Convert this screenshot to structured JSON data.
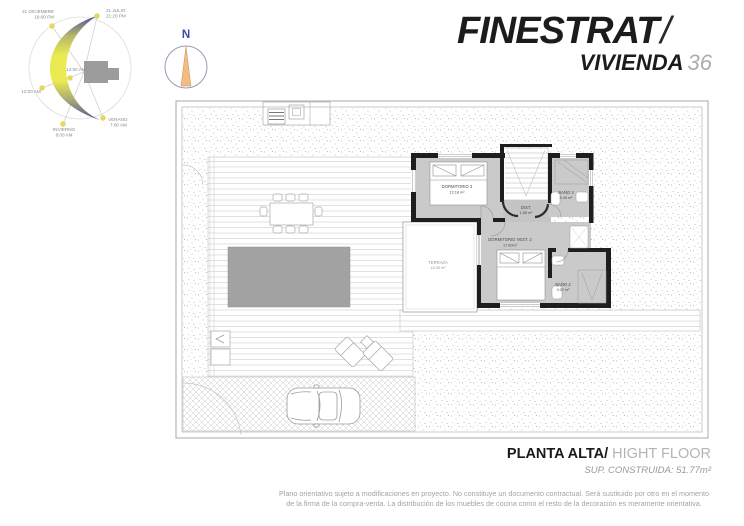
{
  "header": {
    "project_title": "FINESTRAT",
    "title_slash": "/",
    "unit_label": "VIVIENDA",
    "unit_number": "36"
  },
  "compass": {
    "north": "N"
  },
  "sun_diagram": {
    "winter_sunset_date": "21 DICIEMBRE",
    "winter_sunset_time": "18:00 PM",
    "summer_sunset_date": "21 JULIO",
    "summer_sunset_time": "21:20 PM",
    "noon_center": "12:00 AM",
    "noon_left": "12:00 AM",
    "winter_label": "INVIERNO",
    "winter_time": "8:00 AM",
    "summer_label": "VERANO",
    "summer_time": "7:00 AM"
  },
  "floorplan": {
    "rooms": [
      {
        "name": "DORMITORIO 3",
        "area": "12.18 m²"
      },
      {
        "name": "BAÑO 3",
        "area": "5.40 m²"
      },
      {
        "name": "DIST.",
        "area": "1.55 m²"
      },
      {
        "name": "DORMITORIO VEST. 2",
        "area": "17.60m²"
      },
      {
        "name": "TERRAZA",
        "area": "16.08 m²"
      },
      {
        "name": "BAÑO 2",
        "area": "4.07 m²"
      }
    ]
  },
  "footer": {
    "floor_name_es": "PLANTA ALTA/",
    "floor_name_en": "HIGHT FLOOR",
    "built_surface": "SUP. CONSTRUIDA: 51.77m²"
  },
  "disclaimer": {
    "line1": "Plano orientativo sujeto a modificaciones en proyecto. No constituye un documento contractual. Será sustituido por otro en el momento",
    "line2": "de la firma de la compra-venta. La distribución de los muebles de cocina como el resto de la decoración es meramente orientativa."
  },
  "colors": {
    "wall": "#1e1e1e",
    "room_floor": "#cacaca",
    "pool": "#a2a2a2",
    "crescent_yellow": "#ecea52",
    "crescent_blue": "#54549b",
    "compass_needle": "#f2bd82",
    "compass_north": "#3a4aa0",
    "muted_text": "#9a9a9a"
  }
}
